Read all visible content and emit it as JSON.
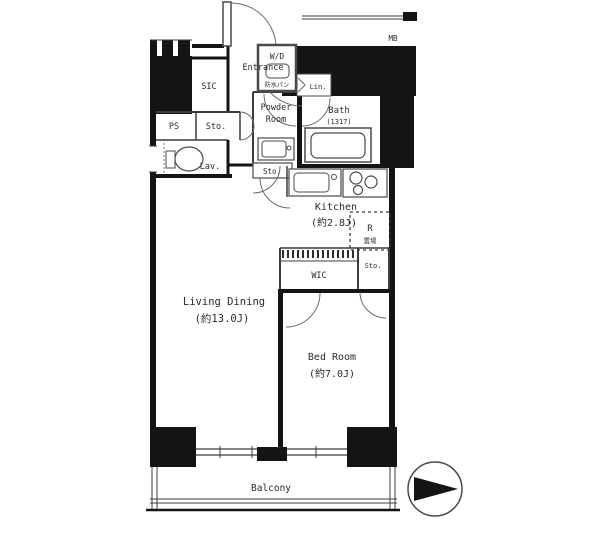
{
  "floorplan": {
    "rooms": {
      "living": {
        "name": "Living Dining",
        "size": "(約13.0J)"
      },
      "bedroom": {
        "name": "Bed Room",
        "size": "(約7.0J)"
      },
      "kitchen": {
        "name": "Kitchen",
        "size": "(約2.8J)"
      },
      "bath": {
        "name": "Bath",
        "size": "(1317)"
      },
      "powder_room": {
        "line1": "Powder",
        "line2": "Room"
      },
      "balcony": {
        "name": "Balcony"
      },
      "entrance": {
        "name": "Entrance"
      },
      "lavatory": {
        "name": "Lav."
      },
      "sic": {
        "name": "SIC"
      },
      "wic": {
        "name": "WIC"
      },
      "pipe_space": {
        "name": "PS"
      },
      "storage_top": {
        "name": "Sto."
      },
      "storage_mid": {
        "name": "Sto."
      },
      "storage_bed": {
        "name": "Sto."
      },
      "linen": {
        "name": "Lin."
      },
      "meter_box": {
        "name": "MB"
      },
      "washer_dryer": {
        "name": "W/D",
        "sub": "防水パン"
      },
      "refrigerator": {
        "name": "R",
        "sub": "置場"
      }
    },
    "colors": {
      "wall": "#141414",
      "line": "#3c3c3c",
      "text": "#2b2b2b",
      "bg": "#ffffff"
    }
  }
}
